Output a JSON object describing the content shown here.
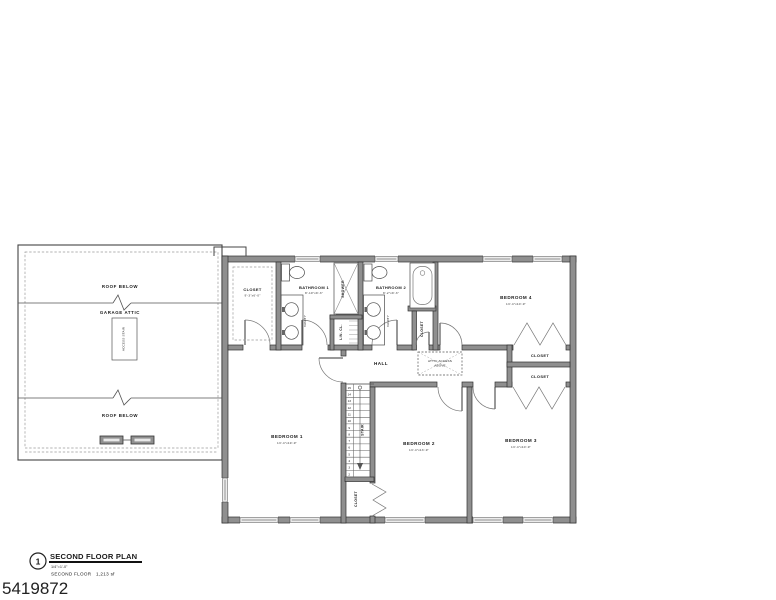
{
  "page": {
    "drawing_number": "5419872",
    "background": "#ffffff",
    "line_color": "#2f2f2f",
    "wall_fill": "#8f8f8f"
  },
  "title_block": {
    "bubble_number": "1",
    "title": "SECOND FLOOR PLAN",
    "scale": "1/4\"=1'-0\"",
    "floor_note": "SECOND FLOOR",
    "area": "1,213 sf"
  },
  "left_wing": {
    "roof_below_top": "ROOF BELOW",
    "garage_attic_label": "GARAGE ATTIC",
    "access_stair_label": "ACCESS STAIR",
    "roof_below_bottom": "ROOF BELOW"
  },
  "rooms": {
    "walkin_closet": {
      "name": "CLOSET",
      "dims": "9'-3\"x6'-0\""
    },
    "bathroom1": {
      "name": "BATHROOM 1",
      "dims": "8'-10\"x9'-3\""
    },
    "bathroom2": {
      "name": "BATHROOM 2",
      "dims": "8'-2\"x9'-3\""
    },
    "bedroom1": {
      "name": "BEDROOM 1",
      "dims": "13'-4\"x19'-9\""
    },
    "bedroom2": {
      "name": "BEDROOM 2",
      "dims": "13'-4\"x13'-9\""
    },
    "bedroom3": {
      "name": "BEDROOM 3",
      "dims": "13'-4\"x10'-9\""
    },
    "bedroom4": {
      "name": "BEDROOM 4",
      "dims": "13'-4\"x10'-9\""
    },
    "hall": "HALL",
    "stair_label": "STAIR",
    "shower_label": "SHOWER",
    "linen_closet": "LIN. CL.",
    "bath2_closet": "CLOSET",
    "closet_r1": "CLOSET",
    "closet_r2": "CLOSET",
    "stair_closet": "CLOSET",
    "attic_access_line1": "ATTIC ACCESS",
    "attic_access_line2": "ABOVE",
    "vanity_label": "VANITY"
  },
  "stairs": {
    "numbers": [
      "15",
      "14",
      "13",
      "12",
      "11",
      "10",
      "9",
      "8",
      "7",
      "6",
      "5",
      "4",
      "3",
      "2"
    ]
  }
}
